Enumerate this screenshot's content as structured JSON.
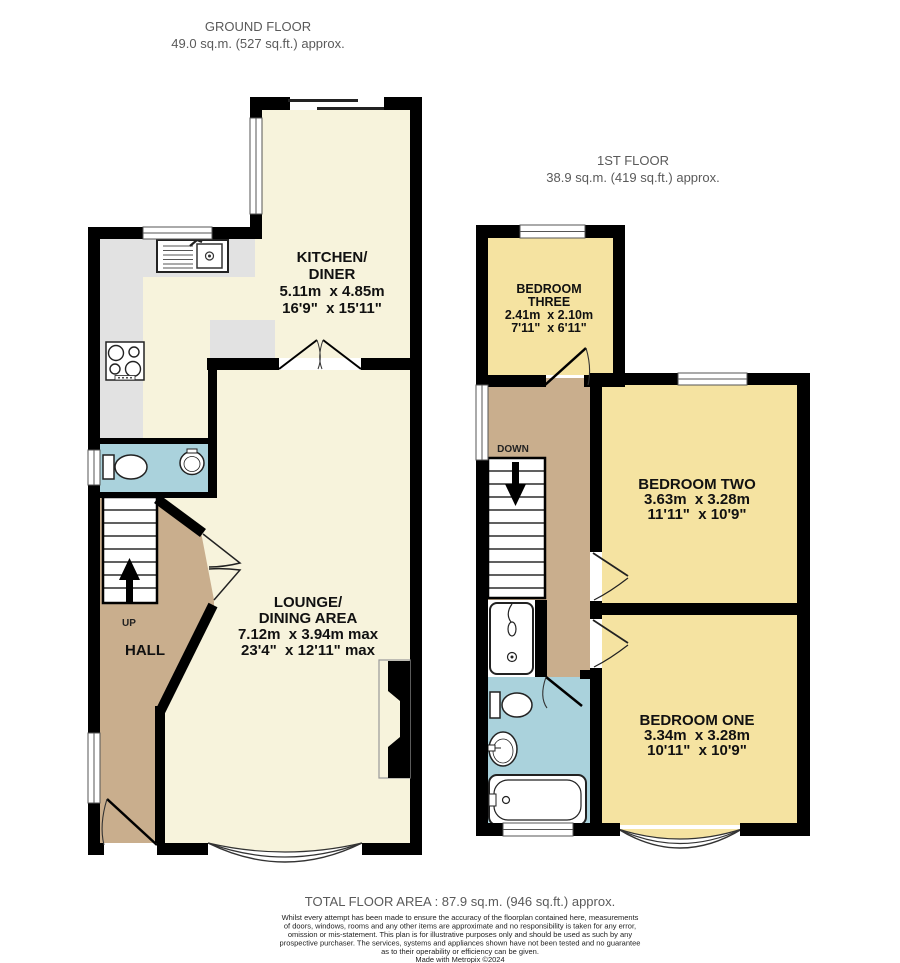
{
  "ground_floor": {
    "title": "GROUND FLOOR",
    "area": "49.0 sq.m. (527 sq.ft.) approx.",
    "rooms": {
      "kitchen": {
        "name1": "KITCHEN/",
        "name2": "DINER",
        "metric": "5.11m  x 4.85m",
        "imperial": "16'9\"  x 15'11\""
      },
      "lounge": {
        "name1": "LOUNGE/",
        "name2": "DINING AREA",
        "metric": "7.12m  x 3.94m max",
        "imperial": "23'4\"  x 12'11\" max"
      },
      "hall": {
        "name": "HALL"
      }
    },
    "stairs_label": "UP"
  },
  "first_floor": {
    "title": "1ST FLOOR",
    "area": "38.9 sq.m. (419 sq.ft.) approx.",
    "rooms": {
      "bedroom_three": {
        "name1": "BEDROOM",
        "name2": "THREE",
        "metric": "2.41m  x 2.10m",
        "imperial": "7'11\"  x 6'11\""
      },
      "bedroom_two": {
        "name": "BEDROOM TWO",
        "metric": "3.63m  x 3.28m",
        "imperial": "11'11\"  x 10'9\""
      },
      "bedroom_one": {
        "name": "BEDROOM ONE",
        "metric": "3.34m  x 3.28m",
        "imperial": "10'11\"  x 10'9\""
      }
    },
    "stairs_label": "DOWN"
  },
  "footer": {
    "total_area": "TOTAL FLOOR AREA : 87.9 sq.m. (946 sq.ft.) approx.",
    "disclaimer_lines": [
      "Whilst every attempt has been made to ensure the accuracy of the floorplan contained here, measurements",
      "of doors, windows, rooms and any other items are approximate and no responsibility is taken for any error,",
      "omission or mis-statement. This plan is for illustrative purposes only and should be used as such by any",
      "prospective purchaser. The services, systems and appliances shown have not been tested and no guarantee",
      "as to their operability or efficiency can be given."
    ],
    "credit": "Made with Metropix ©2024"
  },
  "colors": {
    "wall": "#000000",
    "room_cream": "#F7F3DC",
    "room_yellow": "#F5E3A1",
    "hall_tan": "#C9AE8D",
    "bathroom_blue": "#AAD2DC",
    "worktop_gray": "#E2E2E2",
    "title_gray": "#5A5A5A"
  }
}
